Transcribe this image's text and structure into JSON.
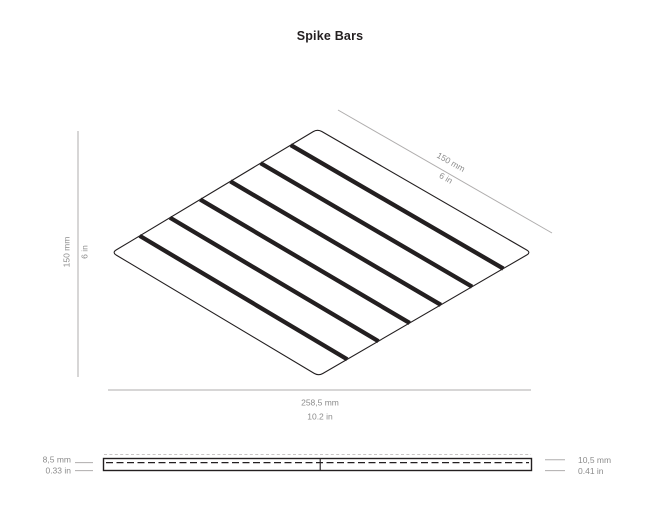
{
  "title": "Spike Bars",
  "colors": {
    "ink": "#231f20",
    "dimension_line": "#afadad",
    "dimension_text": "#8c8c8c",
    "hidden_tip_line": "#c9c6c5"
  },
  "isometric_view": {
    "bar_count": 6,
    "dim_side": {
      "metric": "150 mm",
      "imperial": "6 in"
    },
    "dim_top": {
      "metric": "150 mm",
      "imperial": "6 in"
    },
    "dim_width": {
      "metric": "258,5 mm",
      "imperial": "10.2 in"
    }
  },
  "profile_view": {
    "dim_plate_thickness": {
      "metric": "8,5 mm",
      "imperial": "0.33 in"
    },
    "dim_total_height": {
      "metric": "10,5 mm",
      "imperial": "0.41 in"
    }
  }
}
